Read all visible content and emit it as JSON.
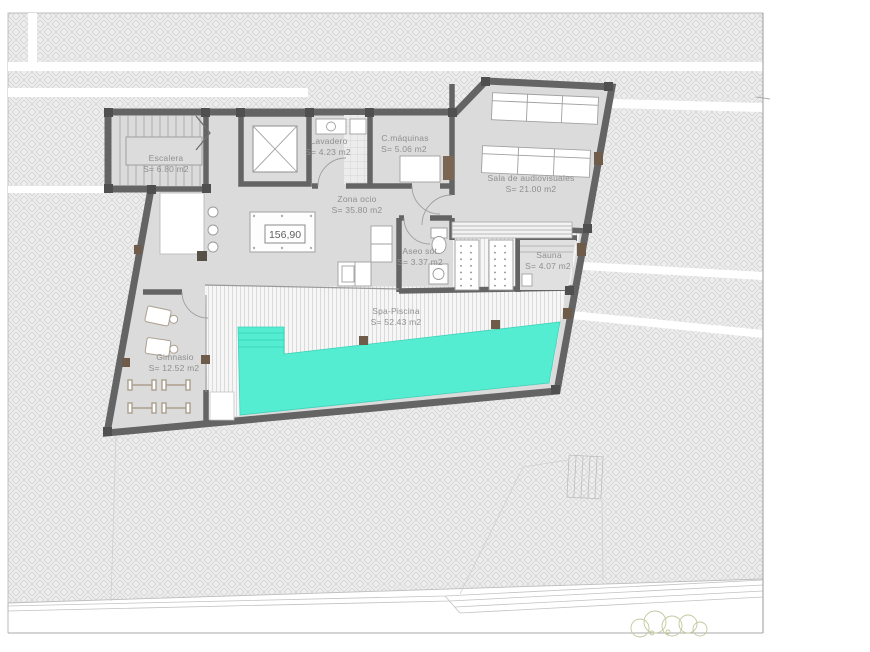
{
  "plan": {
    "level_value": "156,90",
    "rooms": [
      {
        "name": "Escalera",
        "area": "S= 6.80 m2"
      },
      {
        "name": "Lavadero",
        "area": "S= 4.23 m2"
      },
      {
        "name": "C.máquinas",
        "area": "S= 5.06 m2"
      },
      {
        "name": "Sala de audiovisuales",
        "area": "S= 21.00 m2"
      },
      {
        "name": "Zona ocio",
        "area": "S= 35.80 m2"
      },
      {
        "name": "Aseo sót.",
        "area": "S= 3.37 m2"
      },
      {
        "name": "Sauna",
        "area": "S= 4.07 m2"
      },
      {
        "name": "Spa-Piscina",
        "area": "S= 52.43 m2"
      },
      {
        "name": "Gimnasio",
        "area": "S= 12.52 m2"
      }
    ],
    "colors": {
      "pool": "#55EDD1",
      "walls": "#646464",
      "floor": "#DBDBDB",
      "terrain": "#EDEDED",
      "accent_brown": "#6F5B49",
      "label_text": "#8F8F8F",
      "vegetation": "#C3C79D"
    }
  }
}
